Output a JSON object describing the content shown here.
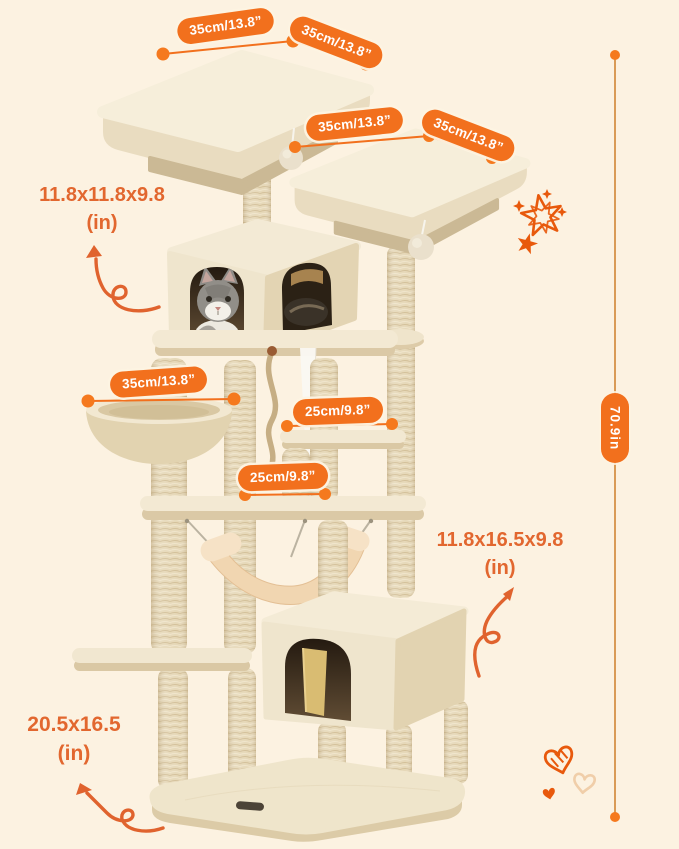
{
  "image": {
    "description": "Cat tree tower product dimension diagram",
    "background_color": "#FCF2E1",
    "accent_color": "#F2701D",
    "label_color": "#E2672F"
  },
  "dimension_badges": [
    {
      "id": "top-perch-width",
      "text": "35cm/13.8”"
    },
    {
      "id": "top-perch-depth",
      "text": "35cm/13.8”"
    },
    {
      "id": "upper-perch-width",
      "text": "35cm/13.8”"
    },
    {
      "id": "upper-perch-depth",
      "text": "35cm/13.8”"
    },
    {
      "id": "basket-level-width",
      "text": "35cm/13.8”"
    },
    {
      "id": "upper-platform-width",
      "text": "25cm/9.8”"
    },
    {
      "id": "lower-platform-width",
      "text": "25cm/9.8”"
    }
  ],
  "total_height_badge": {
    "text": "70.9in"
  },
  "size_labels": [
    {
      "id": "condo-size",
      "line1": "11.8x11.8x9.8",
      "line2": "(in)"
    },
    {
      "id": "lower-house-size",
      "line1": "11.8x16.5x9.8",
      "line2": "(in)"
    },
    {
      "id": "base-size",
      "line1": "20.5x16.5",
      "line2": "(in)"
    }
  ],
  "decorations": {
    "top_right": "star-doodles",
    "bottom_right": "heart-doodles"
  }
}
